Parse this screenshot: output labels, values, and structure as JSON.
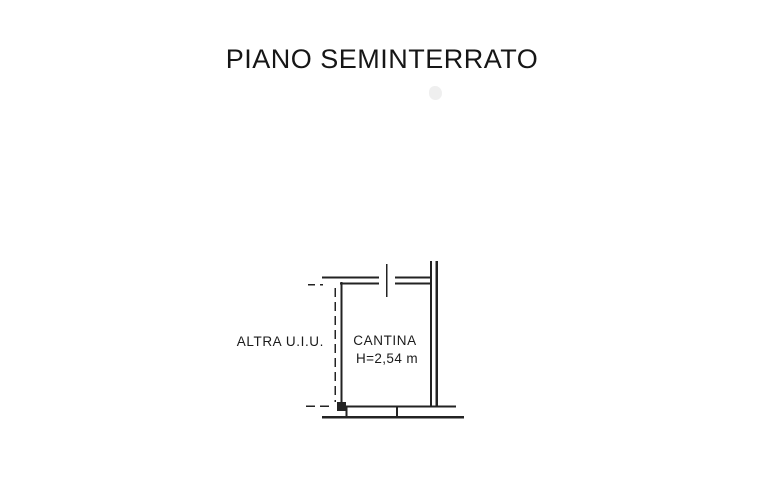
{
  "document": {
    "title": "PIANO SEMINTERRATO",
    "background_color": "#ffffff",
    "ink_color": "#232323"
  },
  "floor_plan": {
    "room": {
      "label": "CANTINA",
      "height_note": "H=2,54 m"
    },
    "adjacent_unit": {
      "label": "ALTRA U.I.U."
    },
    "symbols": {
      "top_opening": "door-opening-mark",
      "bottom_opening": "window-opening",
      "left_boundary": "dashed-party-wall-boundary"
    }
  }
}
